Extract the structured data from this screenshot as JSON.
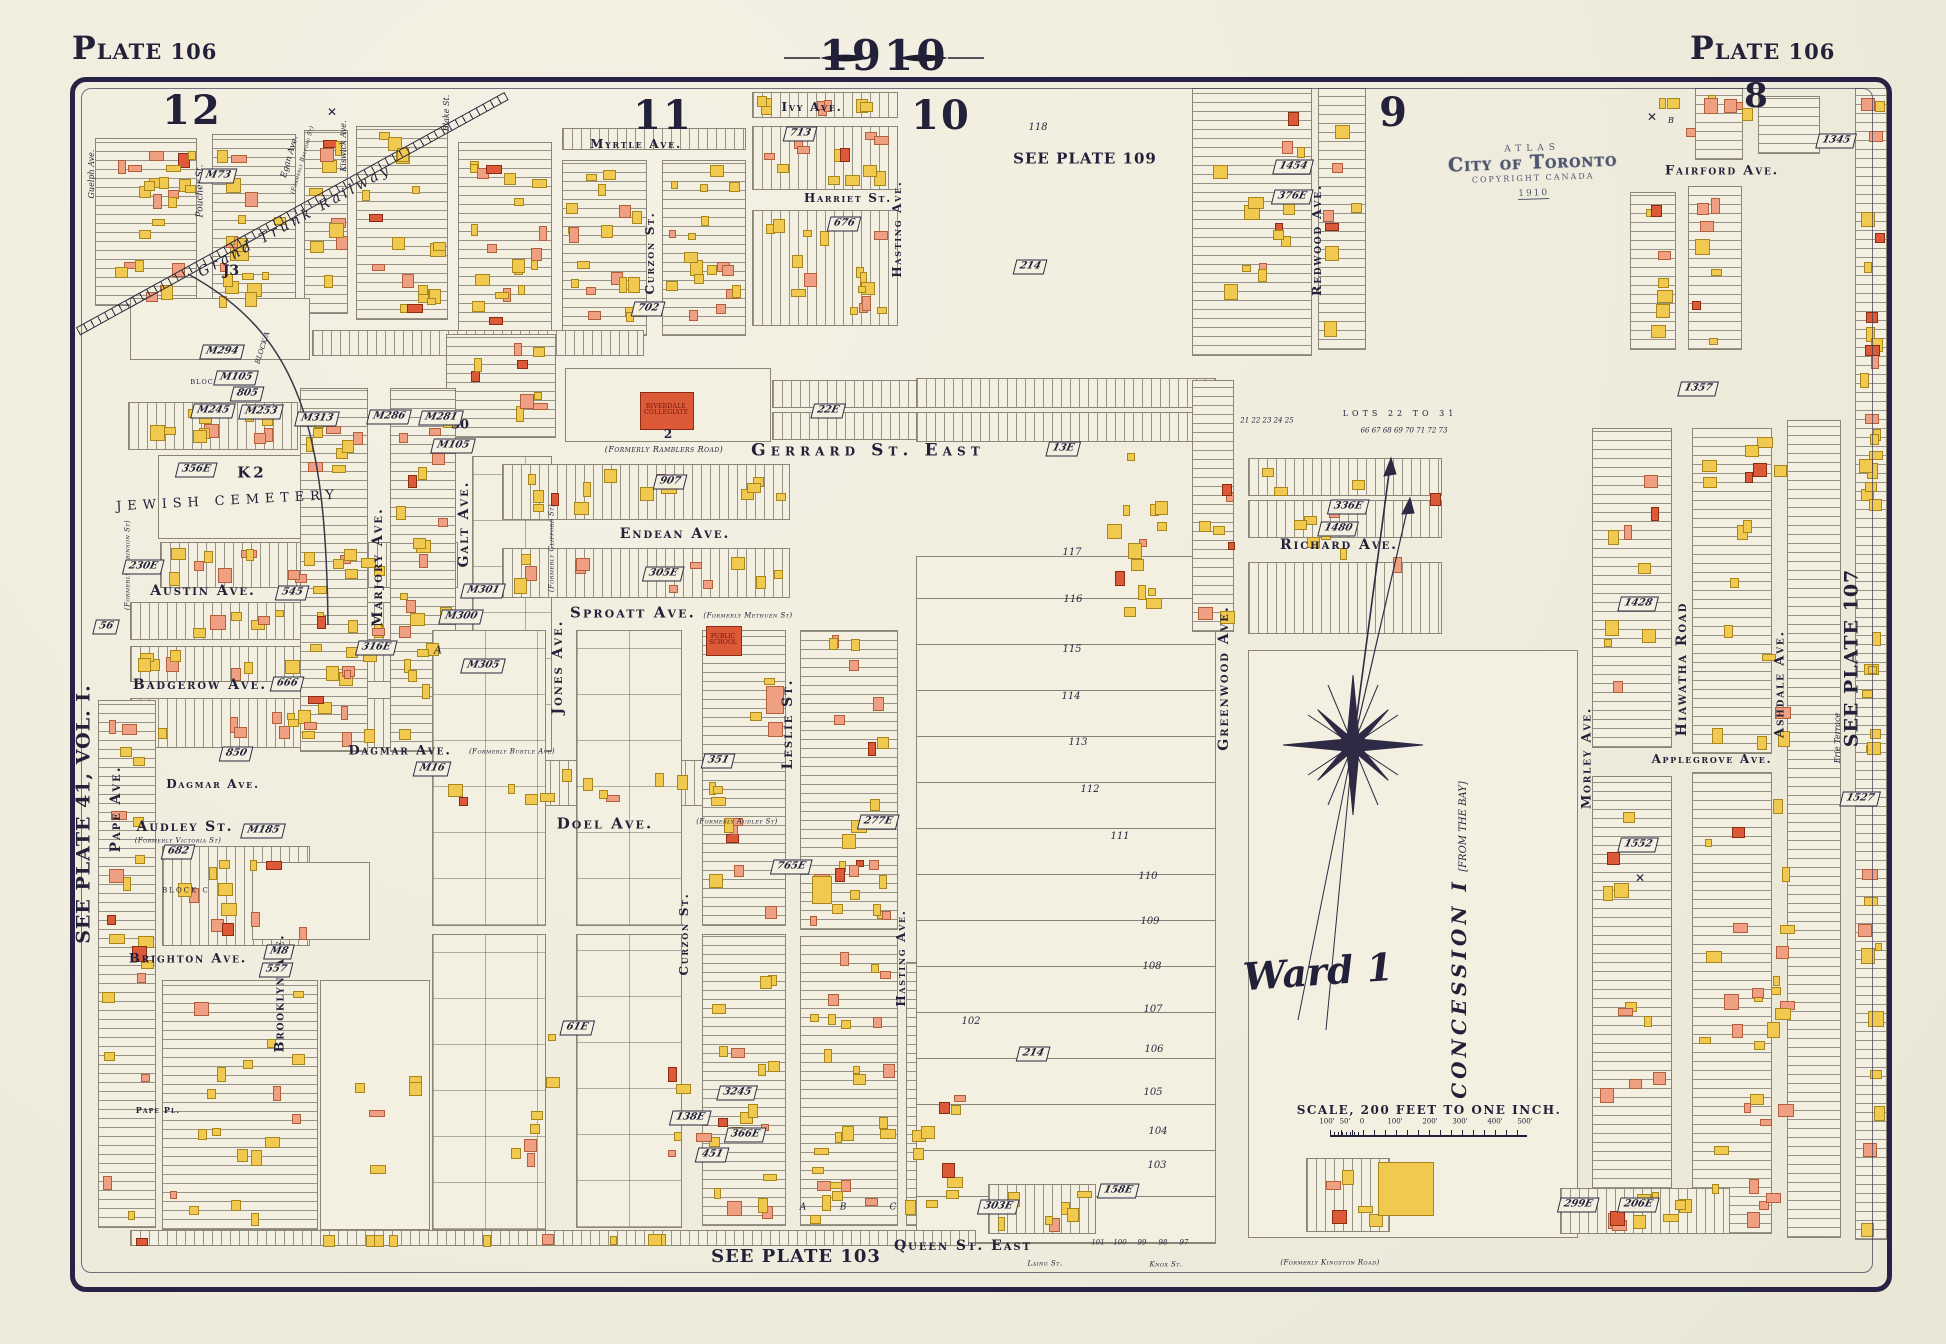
{
  "title": {
    "year": "1910",
    "plate_left": "PLATE 106",
    "plate_right": "PLATE 106"
  },
  "edge_labels": {
    "left": "SEE PLATE 41, VOL. I.",
    "right": "SEE PLATE 107",
    "bottom": "SEE PLATE 103",
    "inner_top": "SEE PLATE 109"
  },
  "sections": [
    "12",
    "11",
    "10",
    "9",
    "8"
  ],
  "stamp": {
    "atlas": "ATLAS",
    "city": "City of Toronto",
    "copyright": "COPYRIGHT CANADA",
    "year": "1910"
  },
  "scale_bar": {
    "label": "SCALE, 200 FEET TO ONE INCH.",
    "ticks": [
      "100'",
      "50'",
      "0",
      "100'",
      "200'",
      "300'",
      "400'",
      "500'"
    ]
  },
  "streets_h": [
    {
      "name": "Ivy Ave."
    },
    {
      "name": "Myrtle Ave."
    },
    {
      "name": "Harriet St."
    },
    {
      "name": "Gerrard St. East",
      "note": "(Formerly Ramblers Road)"
    },
    {
      "name": "Endean Ave."
    },
    {
      "name": "Sproatt Ave.",
      "note": "(Formerly Methuen St)"
    },
    {
      "name": "Austin Ave."
    },
    {
      "name": "Badgerow Ave."
    },
    {
      "name": "Dagmar Ave.",
      "note": "(Formerly Burtle Ave)"
    },
    {
      "name": "Dagmar Ave."
    },
    {
      "name": "Audley St.",
      "note": "(Formerly Victoria St)"
    },
    {
      "name": "Doel Ave.",
      "note": "(Formerly Audley St)"
    },
    {
      "name": "Brighton Ave."
    },
    {
      "name": "Richard Ave."
    },
    {
      "name": "Fairford Ave."
    },
    {
      "name": "Applegrove Ave."
    },
    {
      "name": "Queen St. East",
      "note": "(Formerly Kingston Road)"
    },
    {
      "name": "Pape Pl."
    },
    {
      "name": "Laing St."
    },
    {
      "name": "Knox St."
    }
  ],
  "streets_v": [
    {
      "name": "Guelph Ave."
    },
    {
      "name": "Poucher St."
    },
    {
      "name": "Egan Ave.",
      "note": "(Formerly Balford St)"
    },
    {
      "name": "Kiswick Ave."
    },
    {
      "name": "Blake St."
    },
    {
      "name": "Curzon St."
    },
    {
      "name": "Hasting Ave."
    },
    {
      "name": "Redwood Ave."
    },
    {
      "name": "Marjory Ave."
    },
    {
      "name": "Galt Ave."
    },
    {
      "name": "Jones Ave.",
      "note": "(Formerly Clifford St)"
    },
    {
      "name": "Leslie St."
    },
    {
      "name": "Curzon St."
    },
    {
      "name": "Hasting Ave."
    },
    {
      "name": "Brooklyn Ave."
    },
    {
      "name": "Pape Ave.",
      "note": "(Formerly Robinson St)"
    },
    {
      "name": "Greenwood Ave."
    },
    {
      "name": "Hiawatha Road"
    },
    {
      "name": "Morley Ave."
    },
    {
      "name": "Ashdale Ave."
    },
    {
      "name": "Erie Terrace"
    }
  ],
  "landmarks": {
    "cemetery": "JEWISH CEMETERY",
    "ward": "Ward 1",
    "concession": "CONCESSION I",
    "concession_note": "[FROM THE BAY]",
    "railway": "Grand Trunk Railway",
    "riverdale": "RIVERDALE COLLEGIATE",
    "school": "PUBLIC SCHOOL",
    "survey_mark": "✕"
  },
  "plat_markers": [
    "M73",
    "M294",
    "M105",
    "805",
    "M245",
    "M253",
    "M313",
    "M286",
    "M281",
    "M105",
    "356E",
    "230E",
    "545",
    "316E",
    "56",
    "666",
    "850",
    "M16",
    "M185",
    "682",
    "M8",
    "557",
    "M301",
    "M300",
    "M305",
    "305E",
    "351",
    "907",
    "702",
    "713",
    "676",
    "22E",
    "13E",
    "214",
    "214",
    "1454",
    "376E",
    "336E",
    "1480",
    "1428",
    "1357",
    "1345",
    "1552",
    "1527",
    "61E",
    "3245",
    "138E",
    "451",
    "366E",
    "277E",
    "765E",
    "303E",
    "158E",
    "299E",
    "206E"
  ],
  "lots": {
    "column": [
      "118",
      "117",
      "116",
      "115",
      "114",
      "113",
      "112",
      "111",
      "110",
      "109",
      "108",
      "107",
      "106",
      "105",
      "104",
      "103",
      "102"
    ],
    "bottom_row": [
      "101",
      "100",
      "99",
      "98",
      "97"
    ]
  },
  "misc_labels": [
    "K2",
    "J3",
    "30",
    "BLOCK C",
    "BLOCK A",
    "A",
    "A",
    "B",
    "C",
    "2",
    "LOTS 22 TO 31",
    "66 67 68 69 70 71 72 73",
    "21 22 23 24 25",
    "BLOCK",
    "B"
  ]
}
